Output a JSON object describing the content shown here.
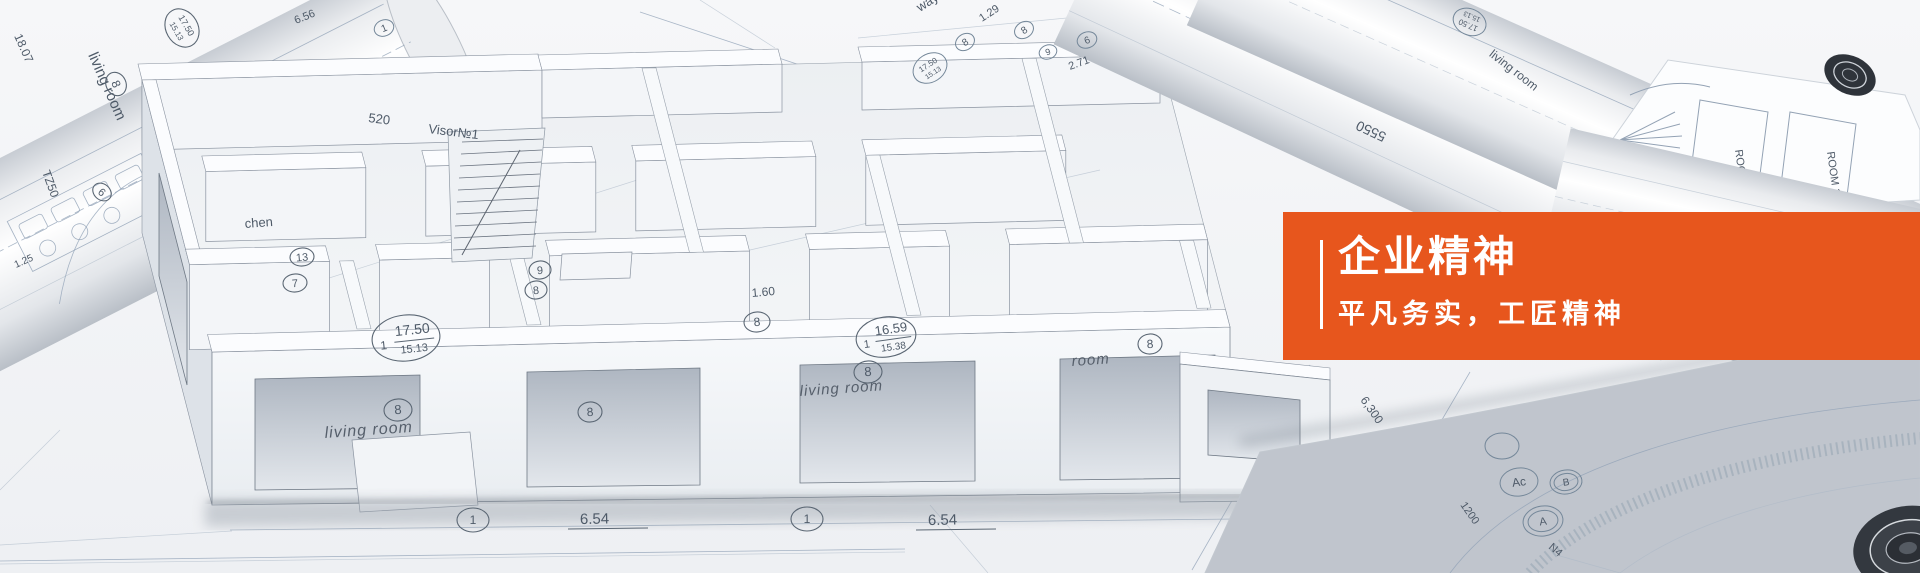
{
  "banner": {
    "title": "企业精神",
    "subtitle": "平凡务实，工匠精神",
    "panel_color": "#e7561d",
    "text_color": "#ffffff"
  },
  "photo": {
    "labels": {
      "living_room": "living room",
      "room": "room",
      "kitchen_partial": "chen",
      "visor": "Visor№1",
      "visor_code": "520",
      "area_1750": "17.50",
      "area_1513": "15.13",
      "area_1659": "16.59",
      "area_1538": "15.38",
      "dim_654": "6.54",
      "dim_656": "6.56",
      "dim_129": "1.29",
      "dim_271": "2.71",
      "dim_160": "1.60",
      "dim_1807": "18.07",
      "dim_125": "1.25",
      "dim_5550": "5550",
      "dim_6300": "6,300",
      "dim_1200": "1200",
      "tz50": "TZ50",
      "hallway_partial": "way",
      "room11": "ROOM 11",
      "n4": "N4",
      "m1": "1",
      "m6": "6",
      "m7": "7",
      "m8": "8",
      "m9": "9",
      "m13": "13",
      "mA": "A",
      "mB": "B",
      "mAc": "Ac"
    }
  }
}
